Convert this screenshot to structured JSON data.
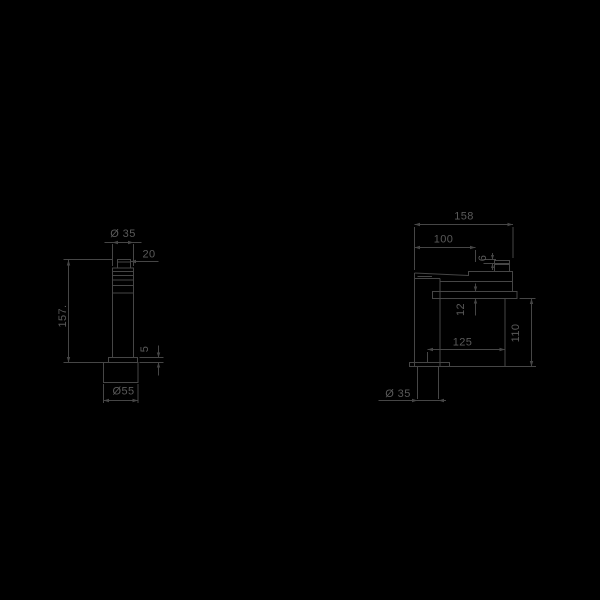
{
  "canvas": {
    "background": "#000000",
    "line_color": "#464646",
    "text_color": "#5a5a5a"
  },
  "drawing": {
    "type": "technical-drawing",
    "subject": "single-lever basin mixer tap, two orthographic views with dimensions (mm)",
    "front_view": {
      "dims": {
        "top_diameter": "Ø 35",
        "handle_width": "20",
        "total_height": "157.",
        "flange_height": "5",
        "base_diameter": "Ø55"
      }
    },
    "side_view": {
      "dims": {
        "total_depth": "158",
        "spout_projection": "100",
        "spout_lip": "6",
        "flange_thickness": "12",
        "body_depth": "125",
        "body_height": "110",
        "shank_diameter": "Ø 35"
      }
    }
  }
}
